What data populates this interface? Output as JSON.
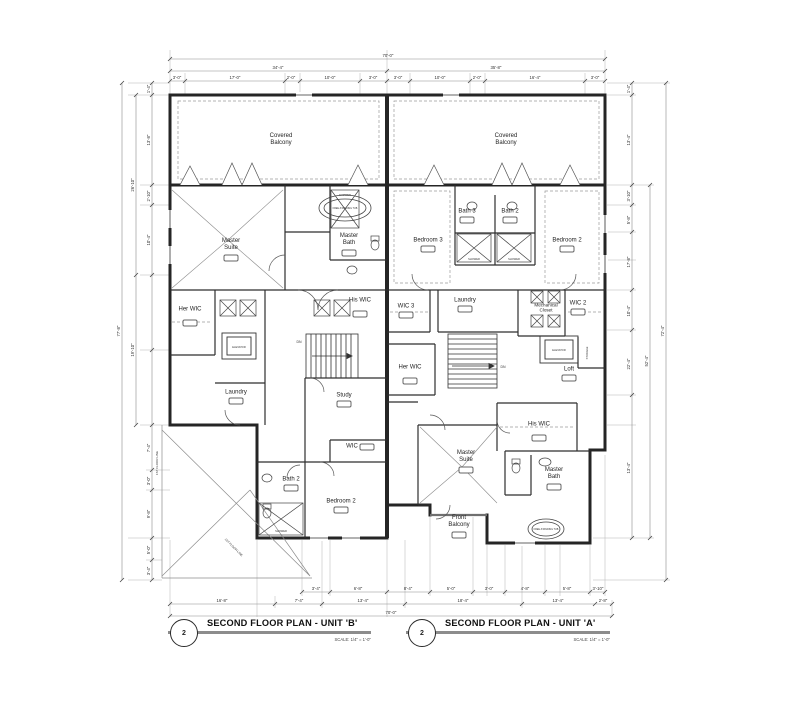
{
  "titles": {
    "b": {
      "number": "2",
      "name": "SECOND FLOOR PLAN - UNIT 'B'",
      "scale": "SCALE: 1/4\" = 1'-0\""
    },
    "a": {
      "number": "2",
      "name": "SECOND FLOOR PLAN - UNIT 'A'",
      "scale": "SCALE: 1/4\" = 1'-0\""
    }
  },
  "unit_b": {
    "covered_balcony": "Covered Balcony",
    "master_suite": "Master Suite",
    "master_bath": "Master Bath",
    "her_wic": "Her WIC",
    "his_wic": "His WIC",
    "laundry": "Laundry",
    "study": "Study",
    "wic": "WIC",
    "bath_2": "Bath 2",
    "bedroom_2": "Bedroom 2",
    "elevator": "ELEVATOR",
    "down": "DN"
  },
  "unit_a": {
    "covered_balcony": "Covered Balcony",
    "bedroom_3": "Bedroom 3",
    "bath_3": "Bath 3",
    "bath_2": "Bath 2",
    "bedroom_2": "Bedroom 2",
    "wic_3": "WIC 3",
    "laundry": "Laundry",
    "mechanical_closet": "Mechanical Closet",
    "wic_2": "WIC 2",
    "her_wic": "Her WIC",
    "elevator": "ELEVATOR",
    "storage": "STORAGE",
    "loft": "Loft",
    "his_wic": "His WIC",
    "master_suite": "Master Suite",
    "master_bath": "Master Bath",
    "front_balcony": "Front Balcony",
    "down": "DN"
  },
  "fixtures": {
    "free_standing_tub": "FREE-STANDING TUB",
    "shower": "SHOWER",
    "first_floor_line": "1ST FLOOR LINE"
  },
  "dims": {
    "top": {
      "total": "70'-0\"",
      "left": "34'-4\"",
      "right": "35'-8\"",
      "row": [
        "3'-0\"",
        "17'-0\"",
        "2'-0\"",
        "10'-0\"",
        "3'-0\"",
        "3'-0\"",
        "10'-0\"",
        "2'-0\"",
        "16'-4\"",
        "3'-0\""
      ]
    },
    "bottom": {
      "total": "70'-0\"",
      "row": [
        "16'-8\"",
        "7'-4\"",
        "13'-4\"",
        "18'-4\"",
        "13'-4\"",
        "2'-8\""
      ],
      "small": [
        "3'-4\"",
        "6'-8\"",
        "8'-4\"",
        "5'-0\"",
        "3'-0\"",
        "4'-8\"",
        "5'-8\"",
        "3'-10\""
      ]
    },
    "left": {
      "total": "77'-8\"",
      "mid": [
        "26'-10\"",
        "19'-10\""
      ],
      "row": [
        "1'-4\"",
        "13'-8\"",
        "2'-10\"",
        "10'-4\"",
        "7'-4\"",
        "3'-0\"",
        "9'-8\"",
        "5'-0\"",
        "3'-4\""
      ]
    },
    "right": {
      "total": "72'-4\"",
      "mid": "52'-4\"",
      "row": [
        "1'-4\"",
        "13'-4\"",
        "3'-10\"",
        "5'-8\"",
        "17'-8\"",
        "10'-4\"",
        "22'-4\"",
        "13'-4\""
      ]
    }
  }
}
